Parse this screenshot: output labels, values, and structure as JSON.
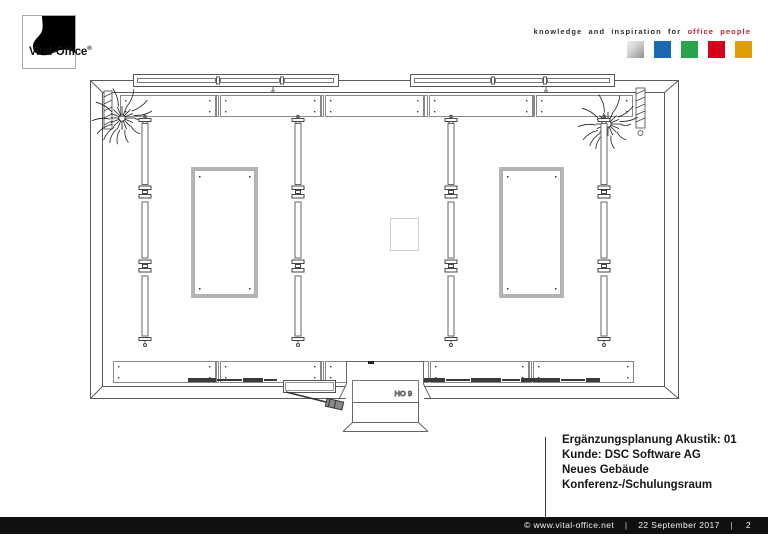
{
  "header": {
    "logo": {
      "brand": "Vital-Office",
      "registered": "®"
    },
    "tagline": {
      "plain": "knowledge and inspiration for",
      "accent": "office people",
      "plain_color": "#2e2e2e",
      "accent_color": "#c42033"
    },
    "squares": [
      {
        "name": "silver",
        "color": "#b8b8b8"
      },
      {
        "name": "blue",
        "color": "#1a6ab2"
      },
      {
        "name": "green",
        "color": "#2aa34d"
      },
      {
        "name": "red",
        "color": "#d6001c"
      },
      {
        "name": "gold",
        "color": "#dda000"
      }
    ]
  },
  "plan": {
    "room_label": "HO 9"
  },
  "titleblock": {
    "lines": [
      "Ergänzungsplanung Akustik: 01",
      "Kunde: DSC Software AG",
      "Neues Gebäude",
      "Konferenz-/Schulungsraum"
    ]
  },
  "footer": {
    "copyright": "©  www.vital-office.net",
    "separator": "|",
    "date": "22 September 2017",
    "page": "2",
    "bg": "#101010"
  }
}
